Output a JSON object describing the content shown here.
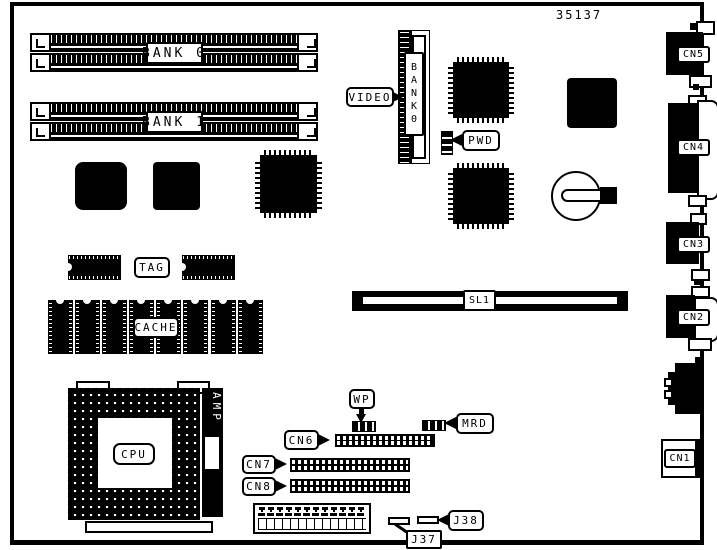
{
  "part_number": "35137",
  "colors": {
    "ink": "#000000",
    "paper": "#ffffff"
  },
  "memory": {
    "bank0": "BANK 0",
    "bank1": "BANK 1"
  },
  "video": {
    "label": "VIDEO",
    "slot_label": "BANK0"
  },
  "jumpers": {
    "pwd": "PWD",
    "wp": "WP",
    "mrd": "MRD",
    "j37": "J37",
    "j38": "J38"
  },
  "cache": {
    "tag": "TAG",
    "cache": "CACHE"
  },
  "cpu": {
    "label": "CPU",
    "amp": "AMP"
  },
  "slots": {
    "sl1": "SL1"
  },
  "headers": {
    "cn6": "CN6",
    "cn7": "CN7",
    "cn8": "CN8"
  },
  "edge_connectors": {
    "cn1": "CN1",
    "cn2": "CN2",
    "cn3": "CN3",
    "cn4": "CN4",
    "cn5": "CN5"
  }
}
